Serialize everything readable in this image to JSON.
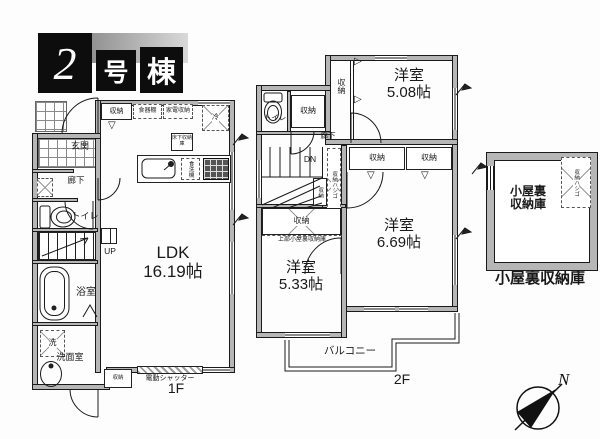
{
  "header": {
    "number": "2",
    "unit_suffix": "号",
    "building_suffix": "棟"
  },
  "common": {
    "closet": "収納",
    "western_room": "洋室",
    "hallway": "廊下",
    "toilet": "トイレ"
  },
  "floor1": {
    "label": "1F",
    "entrance": "玄関",
    "ldk": "LDK",
    "ldk_size": "16.19帖",
    "bathroom": "浴室",
    "washroom": "洗面室",
    "washer": "洗",
    "stairs_up": "UP",
    "dish_cabinet": "食器棚",
    "appliance_storage": "家電収納",
    "refrigerator": "冷",
    "underfloor_storage": "床下収納庫",
    "dishwasher": "食洗機",
    "electric_shutter": "電動シャッター"
  },
  "floor2": {
    "label": "2F",
    "room_a_size": "5.08帖",
    "room_b_size": "6.69帖",
    "room_c_size": "5.33帖",
    "stairs_down": "DN",
    "storage_ladder": "収納ハシゴ",
    "upper_attic_note": "上部小屋裏収納庫",
    "balcony": "バルコニー"
  },
  "attic": {
    "name_line1": "小屋裏",
    "name_line2": "収納庫",
    "storage_ladder": "収納ハシゴ",
    "caption": "小屋裏収納庫"
  },
  "compass": {
    "north": "N"
  },
  "icons": {
    "hanger_down": "▽",
    "hanger_right": "▷"
  }
}
